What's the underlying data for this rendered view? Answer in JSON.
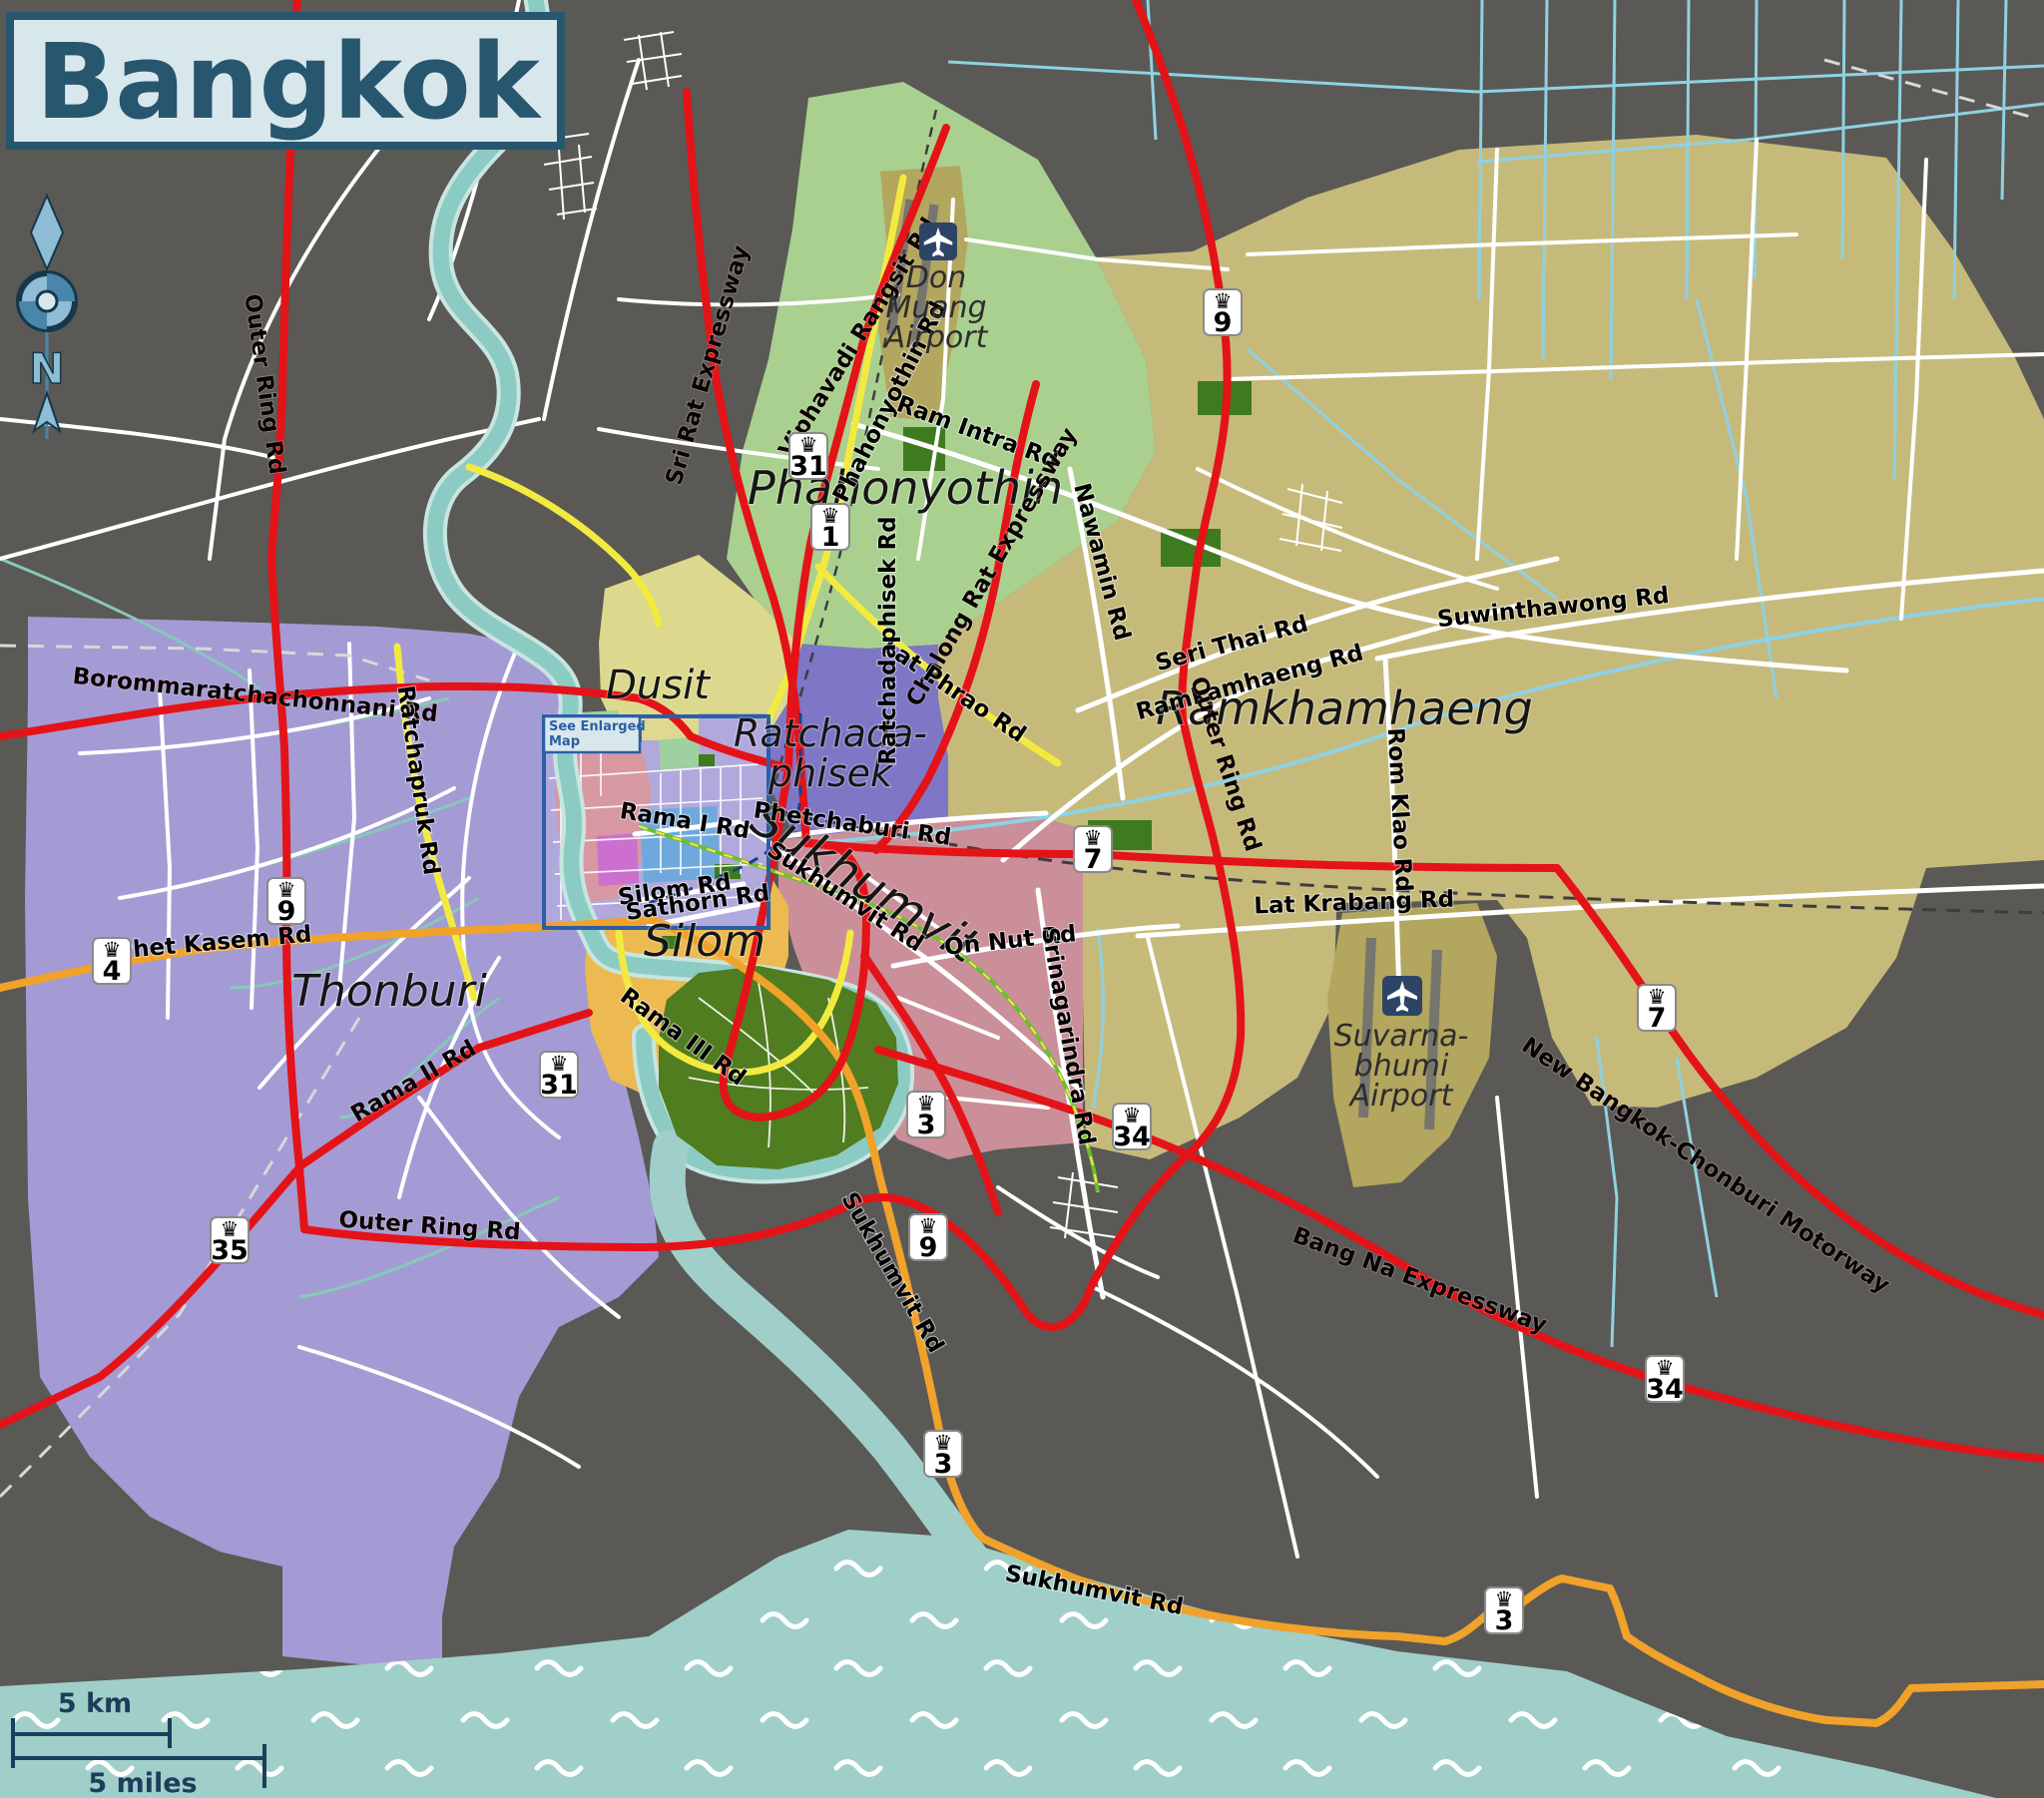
{
  "title": "Bangkok",
  "enlarged_note": {
    "line1": "See Enlarged",
    "line2": "Map"
  },
  "compass": {
    "north": "N"
  },
  "scale_bar": {
    "km": "5 km",
    "miles": "5 miles"
  },
  "icons": {
    "route_crown_glyph": "♛"
  },
  "colors": {
    "land": "#5a5955",
    "sea": "#9fcfc8",
    "river": "#8ccbc4",
    "river_casing": "#c8e5e0",
    "canal": "#8ed2e2",
    "canal_green": "#86c9b8",
    "road_white": "#ffffff",
    "road_red": "#e41318",
    "road_yellow": "#f3ea40",
    "road_orange": "#f0a22a",
    "transit_green": "#6abf2e",
    "transit_yellow": "#ffe14d",
    "transit_blue": "#1b3f8f",
    "railway": "#3d3d3d",
    "boundary": "#d8d8d8",
    "district_thonburi": "#a49bd4",
    "district_phahonyothin": "#a9d08f",
    "district_ramkhamhaeng": "#c6ba7b",
    "district_dusit": "#dcd88d",
    "district_ratchadaphisek": "#7d77c5",
    "district_sukhumvit": "#ca8f99",
    "district_silom": "#ecba50",
    "inner_lavender": "#b1a8dc",
    "inner_rose": "#d898a2",
    "inner_magenta": "#cc6fd0",
    "inner_blue": "#6fa8dc",
    "inner_green": "#9fd0a0",
    "inner_yellow": "#ded98e",
    "park": "#3e7a1e",
    "forest": "#4f7d1f",
    "airport_ground": "#b3a65e",
    "runway": "#76756e",
    "airport_icon_bg": "#2e4467",
    "title_bg": "#d8e7eb",
    "title_color": "#27566f",
    "shield_bg": "#ffffff",
    "shield_border": "#8a8a8a",
    "scale_color": "#1d3d5c",
    "compass_blue": "#8fbdd6",
    "compass_mid": "#4a86ab",
    "compass_dark": "#16384a",
    "enlarged_box": "#2b5fa5"
  },
  "districts": [
    {
      "name": "Phahonyothin"
    },
    {
      "name": "Ramkhamhaeng"
    },
    {
      "name": "Dusit"
    },
    {
      "name": "Ratchada-",
      "name2": "phisek"
    },
    {
      "name": "Sukhumvit"
    },
    {
      "name": "Silom"
    },
    {
      "name": "Thonburi"
    }
  ],
  "airports": [
    {
      "lines": [
        "Don",
        "Muang",
        "Airport"
      ]
    },
    {
      "lines": [
        "Suvarna-",
        "bhumi",
        "Airport"
      ]
    }
  ],
  "road_labels": {
    "outer_ring_w": "Outer Ring Rd",
    "outer_ring_s": "Outer Ring Rd",
    "outer_ring_e": "Outer Ring Rd",
    "borommaratchachonnani": "Borommaratchachonnani Rd",
    "ratchapruk": "Ratchapruk Rd",
    "phet_kasem": "Phet Kasem Rd",
    "rama_ii": "Rama II Rd",
    "rama_iii": "Rama III Rd",
    "sri_rat": "Sri Rat Expressway",
    "viphavadi": "Viphavadi Rangsit Rd",
    "phahonyothin_rd": "Phahonyothin Rd",
    "ram_intra": "Ram Intra Rd",
    "chalong_rat": "Chalong Rat Expressway",
    "lat_phrao": "Lat Phrao Rd",
    "ratchadaphisek_rd": "Ratchadaphisek Rd",
    "nawamin": "Nawamin Rd",
    "seri_thai": "Seri Thai Rd",
    "ramkamhaeng": "Ramkamhaeng Rd",
    "suwinthawong": "Suwinthawong Rd",
    "rom_klao": "Rom Klao Rd",
    "lat_krabang": "Lat Krabang Rd",
    "phetchaburi": "Phetchaburi Rd",
    "rama_i": "Rama I Rd",
    "silom_rd": "Silom Rd",
    "sathorn": "Sathorn Rd",
    "sukhumvit_city": "Sukhumvit Rd",
    "sukhumvit_s": "Sukhumvit Rd",
    "sukhumvit_coast": "Sukhumvit Rd",
    "on_nut": "On Nut Rd",
    "srinagarindra": "Srinagarindra Rd",
    "bang_na": "Bang Na Expressway",
    "new_bkk_chonburi": "New Bangkok-Chonburi Motorway"
  },
  "route_shields": [
    {
      "number": "9"
    },
    {
      "number": "31"
    },
    {
      "number": "1"
    },
    {
      "number": "7"
    },
    {
      "number": "9"
    },
    {
      "number": "4"
    },
    {
      "number": "7"
    },
    {
      "number": "31"
    },
    {
      "number": "3"
    },
    {
      "number": "34"
    },
    {
      "number": "9"
    },
    {
      "number": "35"
    },
    {
      "number": "34"
    },
    {
      "number": "3"
    },
    {
      "number": "3"
    }
  ]
}
